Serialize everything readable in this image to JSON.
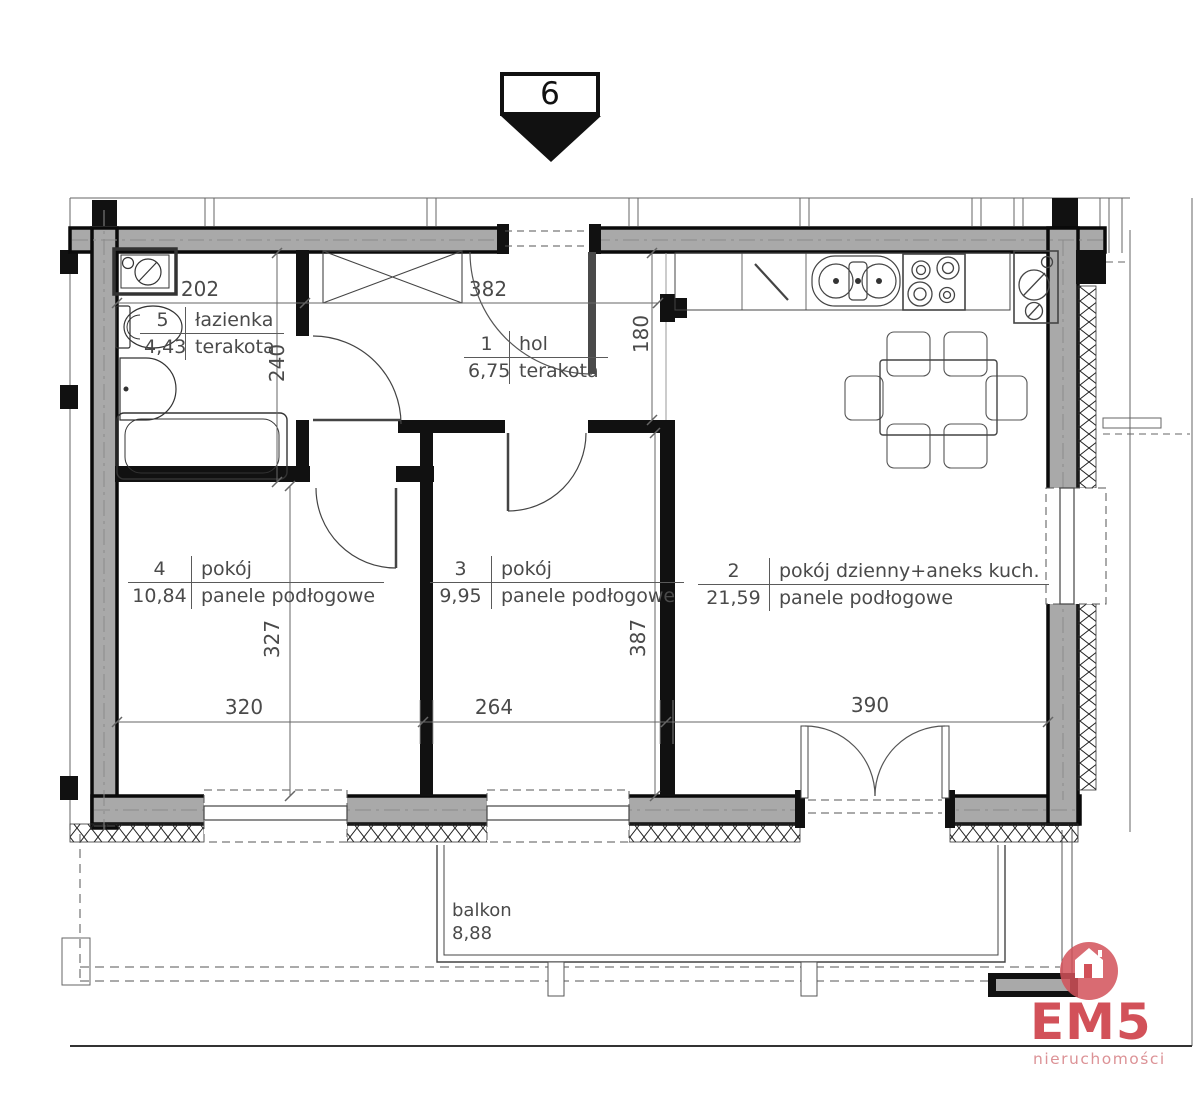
{
  "marker": {
    "number": "6"
  },
  "rooms": {
    "hol": {
      "no": "1",
      "name": "hol",
      "area": "6,75",
      "floor": "terakota"
    },
    "living": {
      "no": "2",
      "name": "pokój dzienny+aneks kuch.",
      "area": "21,59",
      "floor": "panele podłogowe"
    },
    "room3": {
      "no": "3",
      "name": "pokój",
      "area": "9,95",
      "floor": "panele podłogowe"
    },
    "room4": {
      "no": "4",
      "name": "pokój",
      "area": "10,84",
      "floor": "panele podłogowe"
    },
    "bathroom": {
      "no": "5",
      "name": "łazienka",
      "area": "4,43",
      "floor": "terakota"
    }
  },
  "balcony": {
    "name": "balkon",
    "area": "8,88"
  },
  "dims": {
    "bathroom_width": "202",
    "hall_width": "382",
    "bathroom_depth": "240",
    "hall_depth": "180",
    "room4_height": "327",
    "room3_height": "387",
    "room4_width": "320",
    "room3_width": "264",
    "living_width": "390"
  },
  "logo": {
    "name": "EM5",
    "tagline": "nieruchomości",
    "accent": "#d25159",
    "accent_light": "#dc9296"
  },
  "colors": {
    "wall_fill": "#a9a9a9",
    "wall_edge": "#0a0a0a",
    "line": "#4a4a4a"
  }
}
